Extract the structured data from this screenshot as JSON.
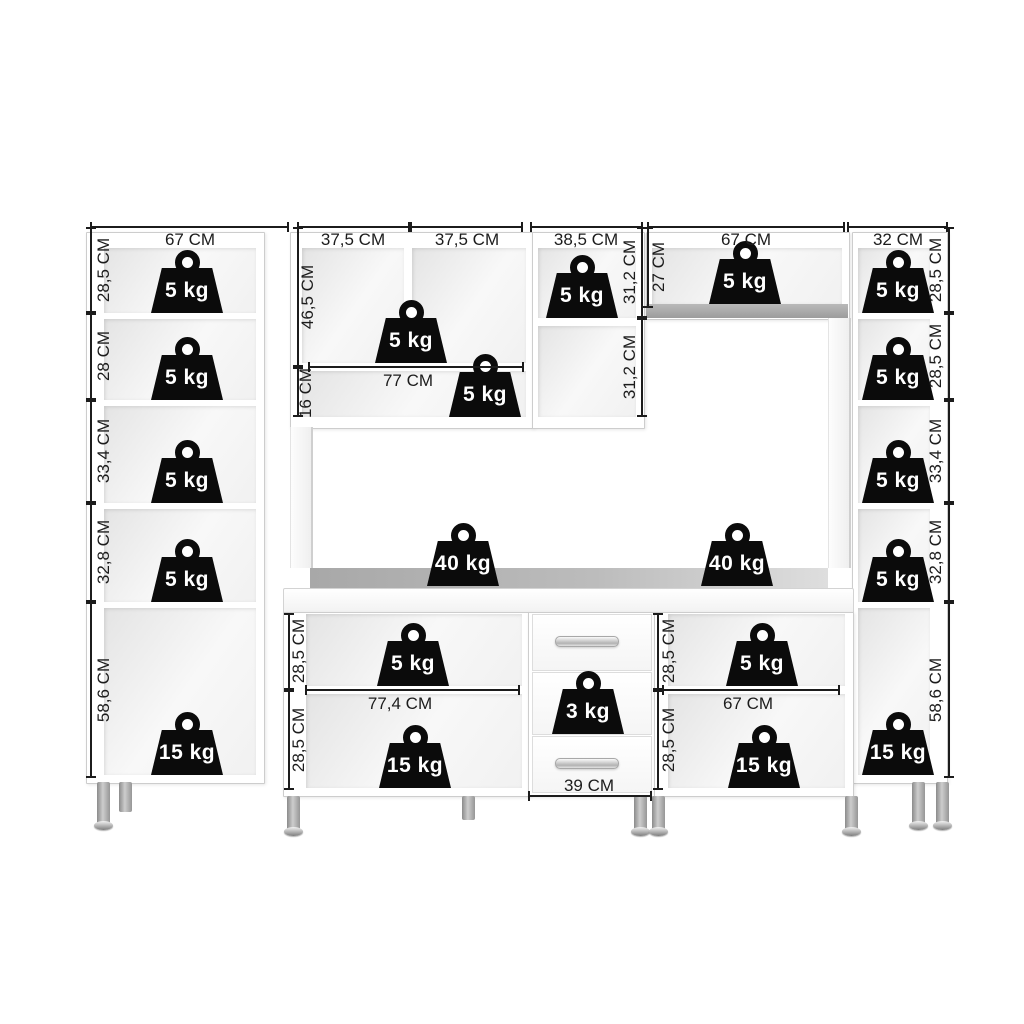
{
  "dims": {
    "left_tall": {
      "width": "67 CM",
      "heights": [
        "28,5 CM",
        "28 CM",
        "33,4 CM",
        "32,8 CM",
        "58,6 CM"
      ]
    },
    "right_tall": {
      "width": "32 CM",
      "heights": [
        "28,5 CM",
        "28,5 CM",
        "33,4 CM",
        "32,8 CM",
        "58,6 CM"
      ]
    },
    "hutch_left": {
      "width_left": "37,5 CM",
      "width_right": "37,5 CM",
      "upper_height": "46,5 CM",
      "shelf_height": "16 CM",
      "shelf_width": "77 CM"
    },
    "hutch_right": {
      "width": "38,5 CM",
      "height_top": "31,2 CM",
      "height_bottom": "31,2 CM"
    },
    "top_shelf": {
      "width": "67 CM",
      "height": "27 CM"
    },
    "base_left": {
      "width": "77,4 CM",
      "height_top": "28,5 CM",
      "height_bottom": "28,5 CM"
    },
    "base_right": {
      "width": "67 CM",
      "height_top": "28,5 CM",
      "height_bottom": "28,5 CM"
    },
    "drawers": {
      "width": "39 CM"
    }
  },
  "caps": {
    "left_tall": [
      "5 kg",
      "5 kg",
      "5 kg",
      "5 kg",
      "15 kg"
    ],
    "right_tall": [
      "5 kg",
      "5 kg",
      "5 kg",
      "5 kg",
      "15 kg"
    ],
    "hutch_upper": "5 kg",
    "hutch_shelf": "5 kg",
    "hutch_right_top": "5 kg",
    "top_shelf": "5 kg",
    "countertop_left": "40 kg",
    "countertop_right": "40 kg",
    "base_left_top": "5 kg",
    "base_left_bottom": "15 kg",
    "drawer_middle": "3 kg",
    "base_right_top": "5 kg",
    "base_right_bottom": "15 kg"
  },
  "colors": {
    "weight": "#0b0b0b",
    "line": "#1c1c1c",
    "countertop": "#b0b0b0"
  }
}
